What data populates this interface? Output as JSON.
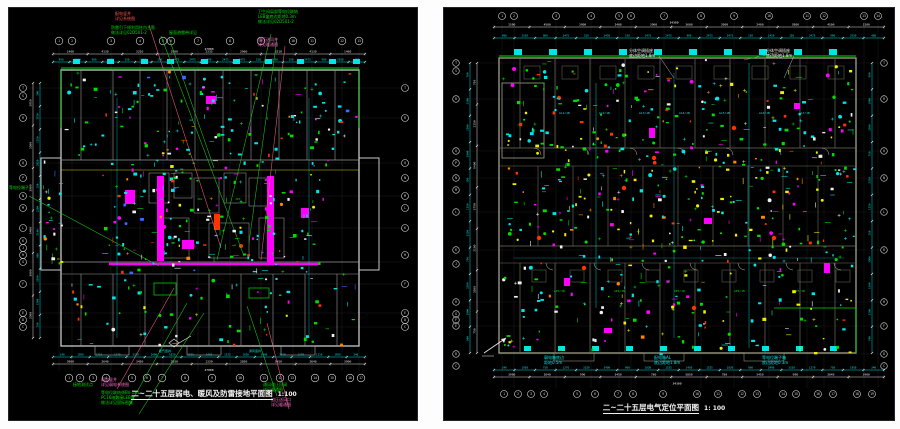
{
  "page": {
    "background": "#fdfdfd",
    "sheet_background": "#000000"
  },
  "palette": {
    "cyan": "#00e5e5",
    "green": "#00dd00",
    "leader_green": "#1ecf1e",
    "yellow": "#efef00",
    "magenta": "#ff00ff",
    "red": "#ff3300",
    "orange": "#ff8800",
    "white": "#f0f0f0",
    "blue": "#3a6bff",
    "pink_leader": "#ff5e86",
    "wall_left": "#c9c9c9",
    "wall_right": "#a3a38c",
    "grid_line": "#606060",
    "bubble": "#dddddd"
  },
  "panels": [
    {
      "name": "riser-hvac-grounding-plan",
      "title": "二~二十五层弱电、暖风及防雷接地平面图",
      "scale_label": "1:100",
      "grid": {
        "top_labels": [
          "1",
          "2",
          "3",
          "4",
          "5",
          "6",
          "7",
          "8",
          "9",
          "10",
          "11",
          "12",
          "13"
        ],
        "bottom_labels": [
          "1",
          "2",
          "3",
          "4",
          "5",
          "6",
          "7",
          "8",
          "9",
          "10",
          "11",
          "12",
          "13",
          "14",
          "15",
          "16",
          "17"
        ],
        "left_labels": [
          "T",
          "S",
          "R",
          "Q",
          "P",
          "N",
          "M",
          "L",
          "K",
          "J",
          "H",
          "G",
          "F",
          "E",
          "D",
          "C"
        ],
        "right_labels": [
          "T",
          "R",
          "Q",
          "N",
          "M",
          "L",
          "K",
          "H",
          "F",
          "E",
          "D",
          "C"
        ]
      },
      "dims": {
        "overall_top": "27000",
        "top_major": [
          "1460",
          "4130",
          "3210",
          "2960",
          "2335",
          "2960",
          "3210",
          "4130",
          "1460"
        ],
        "top_minor": [
          "450",
          "2550",
          "900",
          "3475",
          "150",
          "1450",
          "150",
          "3475",
          "2475",
          "900",
          "2475",
          "3475",
          "150",
          "1450",
          "150",
          "3475",
          "900",
          "2550",
          "450"
        ],
        "overall_bottom": "27000",
        "bottom_major": [
          "3900",
          "2640",
          "3450",
          "2850",
          "1320",
          "2850",
          "3450",
          "2640",
          "3900"
        ],
        "bottom_minor": [
          "240",
          "1950",
          "1210",
          "1270",
          "3320",
          "2400",
          "1020",
          "1525",
          "1450",
          "1525",
          "1020",
          "2400",
          "3320",
          "1270",
          "1210",
          "1950",
          "240"
        ],
        "left_major": [
          "2850",
          "3300",
          "3000",
          "5400",
          "3000",
          "3300"
        ],
        "left_minor": [
          "300",
          "1750",
          "1250",
          "2850",
          "150",
          "1200",
          "2100",
          "900",
          "3300",
          "1500",
          "750"
        ]
      },
      "tags": {
        "core_tags": [
          "JD1",
          "JD2",
          "JD3"
        ],
        "bottom_tags": [
          "暖气竖井",
          "通风竖井"
        ]
      },
      "annotations": {
        "top_red": "配电竖井\n详见系统图",
        "top_green1": "防雷引下线利用柱内主筋\n做法详见02D501-2",
        "top_green2": "屋面避雷带详见",
        "top_green3": "卫生间局部等电位联结\nLEB盒底边距地0.3m\n做法详见02D501-2",
        "top_pink2": "加压送风井\n详见暖通图",
        "left_green": "等电位端子",
        "bot_green0": "接地测试点",
        "bot_pink1": "弱电竖井\n详见弱电系统图",
        "bot_green1": "等电位联结线BV-1x4\nPC16暗敷接LEB盒\n做法详见国标图集",
        "bot_green3": "通风道止回阀\n详见暖通图",
        "bot_pink2": "加压送风口\n详见暖通图"
      }
    },
    {
      "name": "electrical-point-location-plan",
      "title": "二~二十五层电气定位平面图",
      "scale_label": "1: 100",
      "grid": {
        "top_labels": [
          "1",
          "2",
          "3",
          "4",
          "5",
          "6",
          "7",
          "8",
          "9",
          "10",
          "11",
          "12",
          "13",
          "14"
        ],
        "bottom_labels": [
          "1",
          "2",
          "3",
          "4",
          "5",
          "6",
          "7",
          "8",
          "9",
          "10",
          "11",
          "12",
          "13",
          "14",
          "15",
          "16",
          "17",
          "18",
          "19"
        ],
        "left_labels": [
          "T",
          "S",
          "R",
          "Q",
          "P",
          "N",
          "M",
          "L",
          "K",
          "J",
          "H",
          "G",
          "F",
          "E",
          "D",
          "C"
        ],
        "right_labels": [
          "T",
          "R",
          "Q",
          "N",
          "L",
          "K",
          "H",
          "F",
          "D",
          "C"
        ]
      },
      "dims": {
        "overall_top": "34300",
        "top_major": [
          "1500",
          "4500",
          "3900",
          "2400",
          "3900",
          "3600",
          "3900",
          "2400",
          "3900",
          "4500",
          "1500"
        ],
        "top_minor": [
          "480",
          "2550",
          "900",
          "3475",
          "150",
          "1450",
          "150",
          "3475",
          "2475",
          "900",
          "2475",
          "3475",
          "150",
          "1450",
          "150",
          "3475",
          "900",
          "2550",
          "480"
        ],
        "overall_bottom": "34300",
        "bottom_major": [
          "3900",
          "2640",
          "990",
          "3450",
          "780",
          "5850",
          "780",
          "3450",
          "990",
          "2640",
          "3900"
        ],
        "bottom_minor": [
          "240",
          "1950",
          "750",
          "1270",
          "3320",
          "2400",
          "900",
          "1020",
          "1525",
          "1450",
          "1525",
          "1020",
          "900",
          "2400",
          "3320",
          "1270",
          "750",
          "1950",
          "240"
        ],
        "left_major": [
          "750",
          "2250",
          "5400",
          "3750",
          "2100",
          "3300",
          "750"
        ],
        "left_minor": [
          "700",
          "2300",
          "1500",
          "3900",
          "150",
          "1350",
          "2250",
          "750",
          "3300",
          "1800",
          "900"
        ],
        "right_minor": [
          "900",
          "1800",
          "3300",
          "750",
          "2250",
          "1350",
          "150",
          "3900",
          "1500",
          "2300",
          "700"
        ]
      },
      "tags": {
        "unit_tags": [
          "AL1/1B",
          "AL2/1B",
          "AL3/1B",
          "AL4/1B",
          "AL5/1B",
          "AL6/1B",
          "AL7/1B"
        ],
        "green_tags": [
          "AP1/1B",
          "AP2/1B",
          "AP3/1B",
          "AP4/1B",
          "AP5/1B"
        ]
      },
      "annotations": {
        "top_white1": "分体空调插座\n底边距地1.8m",
        "top_white2": "分体空调插座\n底边距地1.8m",
        "bot_cyan1": "弱电箱底边\n距地0.5m",
        "bot_cyan2": "配电箱AL\n底边距地1.8m",
        "bot_cyan3": "等电位端子箱\n底边距地0.3m"
      }
    }
  ]
}
